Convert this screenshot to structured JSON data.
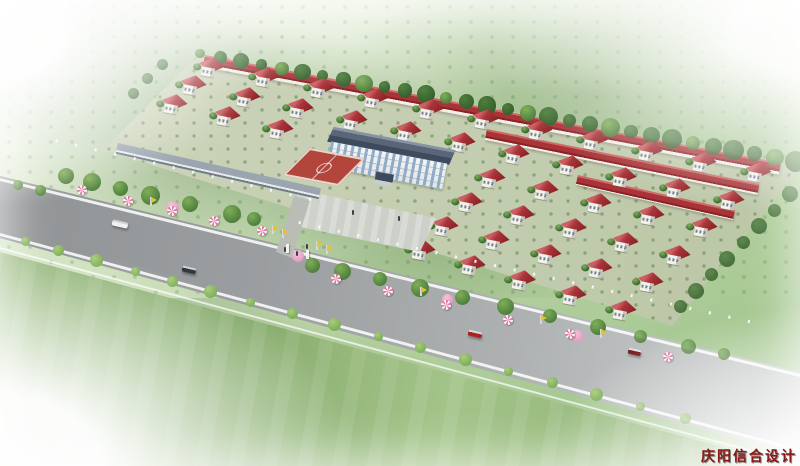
{
  "scene": {
    "type": "aerial-architectural-rendering",
    "description": "Bird's-eye 3D rendering of a planned rural community: grid of red-roofed villas, terraced row buildings at the rear, central white office building with basketball court and plaza, two roadside commercial strips with umbrellas and flags, a tree-lined highway with cars, misty green fields all around",
    "watermark": "庆阳信合设计",
    "palette": {
      "roof_red": "#a83438",
      "roof_light": "#cb5f63",
      "roof_dark": "#8a2226",
      "wall": "#f3f2ea",
      "wall_shade": "#c8c7bd",
      "shop_roof": "#7e8a96",
      "shop_roof_dark": "#5d6975",
      "shop_glass": "#a2c0d8",
      "shop_glass_dark": "#7fa3c2",
      "walk": "#c49a6f",
      "walk_dark": "#a87a50",
      "tree_dark": "#36602e",
      "tree_mid": "#4e7f3c",
      "tree_light": "#7fae58",
      "blossom": "#e39cc0",
      "court": "#b2453c",
      "umb_pink": "#e07ca6",
      "flag": "#e6c235",
      "car_white": "#eff1f2",
      "car_dark": "#33383d",
      "car_red": "#b02020",
      "car_darkred": "#7c2020",
      "wm": "#8b1616"
    },
    "objects": {
      "villas": 45,
      "villa_rows": 6,
      "villas_per_full_row": 11,
      "terraced_row_buildings": 3,
      "central_building": "white multi-storey office building with dark hip roof",
      "basketball_courts": 1,
      "commercial_strips": 2,
      "shop_units_left": 14,
      "shop_units_right": 20,
      "umbrellas": 11,
      "flags": 8,
      "people": 5,
      "cars": [
        "white",
        "dark",
        "red",
        "dark-red"
      ]
    }
  }
}
